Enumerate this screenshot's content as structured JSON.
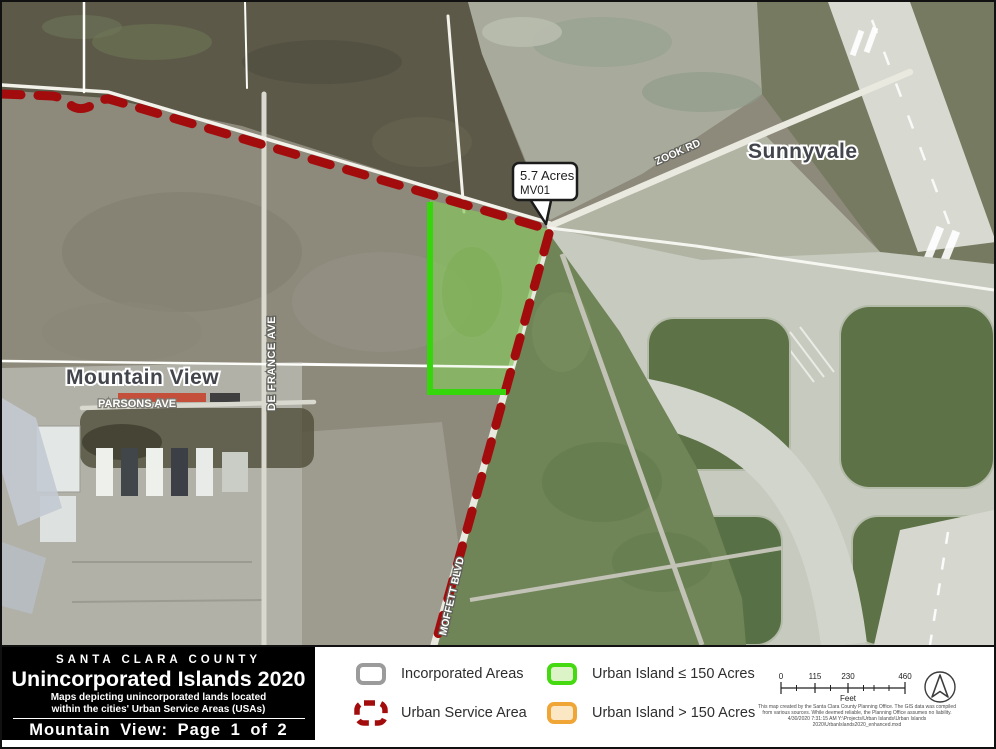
{
  "map": {
    "city_labels": {
      "sunnyvale": "Sunnyvale",
      "mountain_view": "Mountain View"
    },
    "road_labels": {
      "zook_rd": "ZOOK RD",
      "de_france_ave": "DE FRANCE AVE",
      "parsons_ave": "PARSONS AVE",
      "moffett_blvd": "MOFFETT BLVD"
    },
    "callout": {
      "acres": "5.7 Acres",
      "island_id": "MV01"
    }
  },
  "title_block": {
    "county": "SANTA CLARA COUNTY",
    "title": "Unincorporated Islands 2020",
    "subtitle_line1": "Maps depicting unincorporated lands located",
    "subtitle_line2": "within the cities' Urban Service Areas (USAs)",
    "page_label": "Mountain View: Page 1 of 2"
  },
  "legend": {
    "items": [
      {
        "label": "Incorporated Areas"
      },
      {
        "label": "Urban Service Area"
      },
      {
        "label": "Urban Island ≤ 150 Acres"
      },
      {
        "label": "Urban Island > 150 Acres"
      }
    ]
  },
  "scale_bar": {
    "tick_labels": [
      "0",
      "115",
      "230",
      "460"
    ],
    "unit": "Feet"
  },
  "credits": {
    "line1": "This map created by the Santa Clara County Planning Office. The GIS data was compiled",
    "line2": "from various sources. While deemed reliable, the Planning Office assumes no liability.",
    "line3": "4/30/2020 7:31:15 AM   Y:\\Projects\\Urban Islands\\Urban Islands 2020\\UrbanIslands2020_enhanced.mxd"
  },
  "colors": {
    "urban_service_area": "#A30C0C",
    "urban_island_small_border": "#44D911",
    "urban_island_small_fill": "#DCF3C8",
    "urban_island_large_border": "#F0A636",
    "urban_island_large_fill": "#FBE7C3",
    "incorporated_border": "#9B9B9B"
  }
}
